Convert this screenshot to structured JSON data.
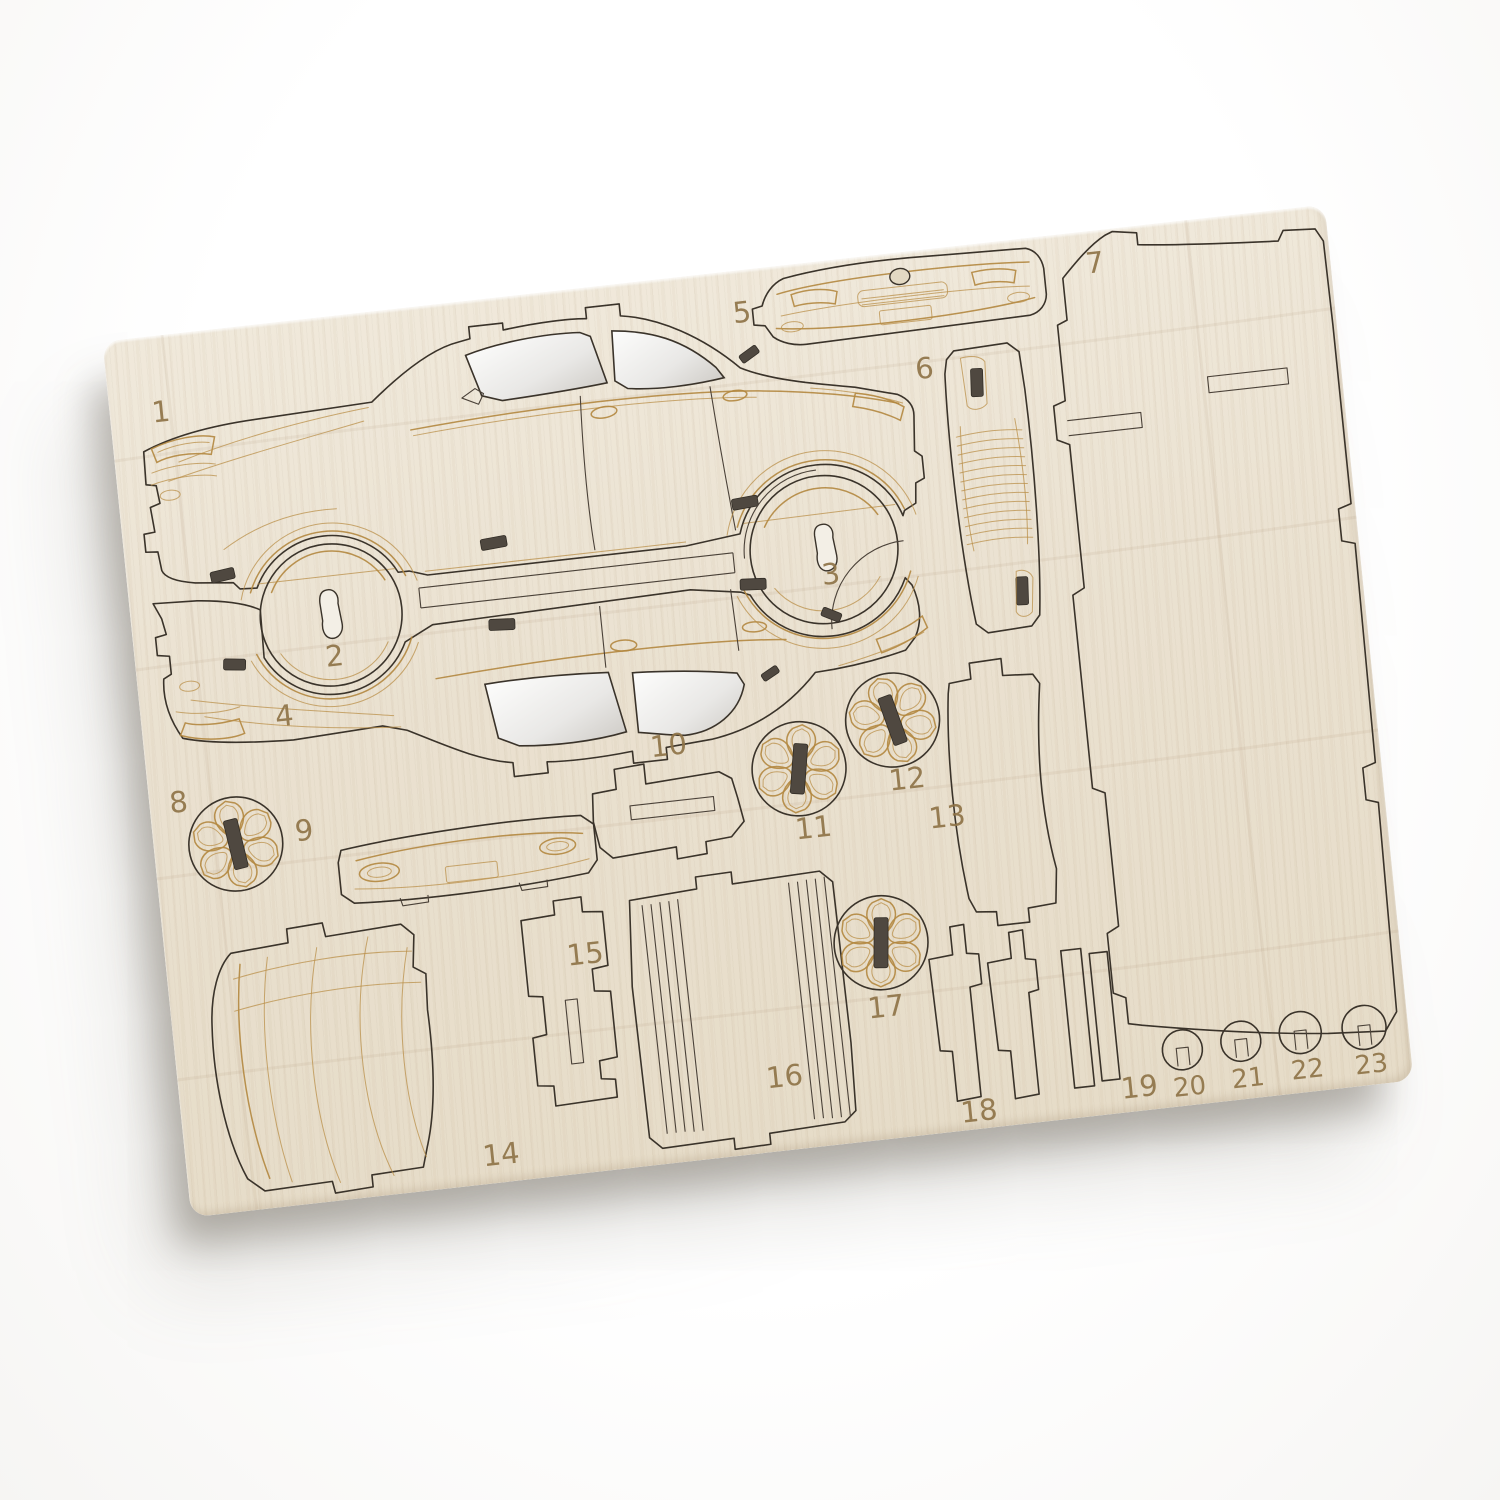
{
  "product": {
    "name": "laser-cut plywood 3D car model kit sheet",
    "background_color": "#ffffff",
    "board": {
      "wood_color": "#eae1d0",
      "cut_line_color": "#3a332a",
      "engrave_color": "#b2873f",
      "slot_color": "#4f4840",
      "window_cutout_color": "#f5f4f2",
      "rotation_deg": -6.4,
      "corner_radius_px": 18
    }
  },
  "parts": [
    {
      "number": "1",
      "name": "car-body-side-panel-a"
    },
    {
      "number": "2",
      "name": "front-wheel-bay-disc"
    },
    {
      "number": "3",
      "name": "rear-wheel-bay-disc"
    },
    {
      "number": "4",
      "name": "car-body-side-panel-b"
    },
    {
      "number": "5",
      "name": "front-bumper-panel"
    },
    {
      "number": "6",
      "name": "radiator-grille-panel"
    },
    {
      "number": "7",
      "name": "chassis-base-panel"
    },
    {
      "number": "8",
      "name": "wheel-disc"
    },
    {
      "number": "9",
      "name": "rear-bumper-panel"
    },
    {
      "number": "10",
      "name": "mounting-bracket"
    },
    {
      "number": "11",
      "name": "wheel-disc"
    },
    {
      "number": "12",
      "name": "wheel-disc"
    },
    {
      "number": "13",
      "name": "fender-brace"
    },
    {
      "number": "14",
      "name": "windscreen-panel"
    },
    {
      "number": "15",
      "name": "axle-bracket"
    },
    {
      "number": "16",
      "name": "kerf-bend-panel"
    },
    {
      "number": "17",
      "name": "wheel-disc"
    },
    {
      "number": "18",
      "name": "support-strut"
    },
    {
      "number": "19",
      "name": "support-strut"
    },
    {
      "number": "20",
      "name": "headlight-ring"
    },
    {
      "number": "21",
      "name": "headlight-ring"
    },
    {
      "number": "22",
      "name": "headlight-ring"
    },
    {
      "number": "23",
      "name": "headlight-ring"
    }
  ]
}
